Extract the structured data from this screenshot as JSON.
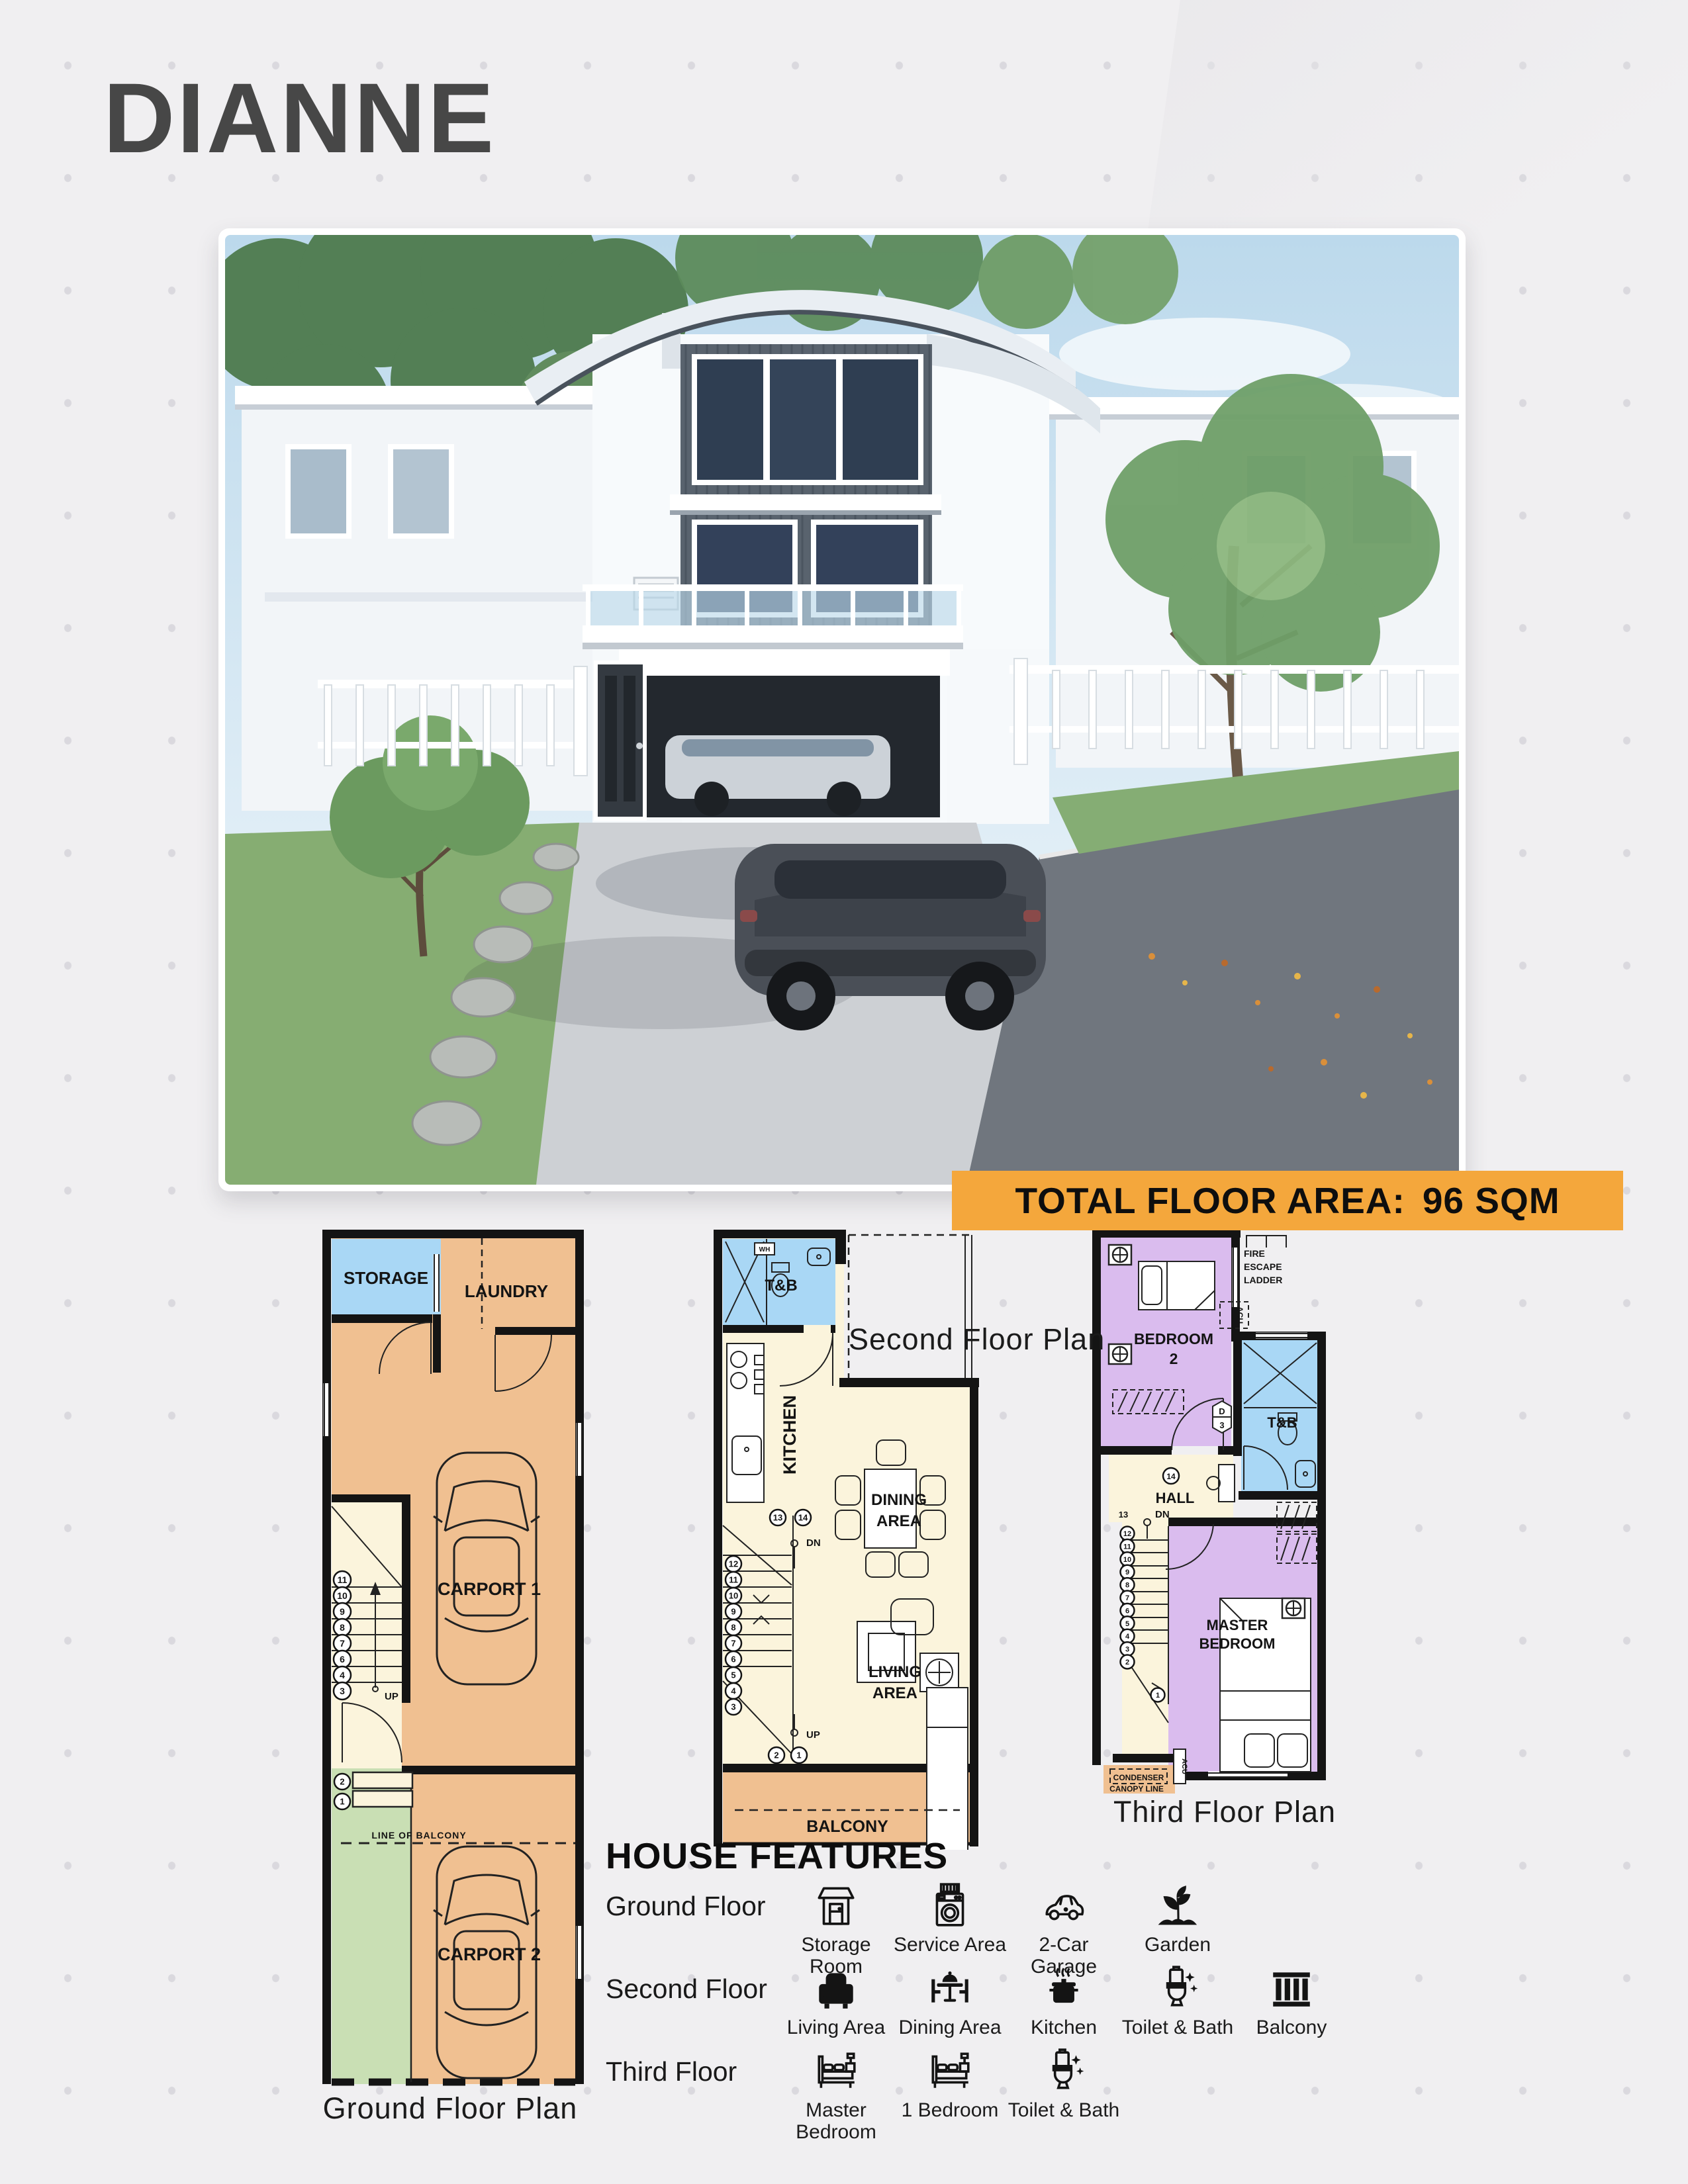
{
  "page": {
    "title": "DIANNE"
  },
  "banner": {
    "label": "TOTAL FLOOR AREA:",
    "value": "96 SQM",
    "bg": "#F4A73C"
  },
  "colors": {
    "background": "#F0EFF1",
    "accent_orange": "#F4A73C",
    "wall": "#141414",
    "room_tan": "#F0C091",
    "room_blue": "#A9D7F5",
    "room_cream": "#FBF4DC",
    "room_purple": "#DABCEE",
    "room_green": "#C9DFB4",
    "title_gray": "#474747"
  },
  "plans": {
    "ground": {
      "caption": "Ground Floor Plan",
      "labels": {
        "storage": "STORAGE",
        "laundry": "LAUNDRY",
        "carport1": "CARPORT 1",
        "carport2": "CARPORT 2",
        "line_of_balcony": "LINE OF BALCONY",
        "up": "UP"
      },
      "stairs": {
        "main": [
          "11",
          "10",
          "9",
          "8",
          "7",
          "6",
          "4",
          "3"
        ],
        "landing": [
          "2",
          "1"
        ]
      }
    },
    "second": {
      "caption": "Second Floor Plan",
      "labels": {
        "tb": "T&B",
        "wh": "WH",
        "kitchen": "KITCHEN",
        "dining1": "DINING",
        "dining2": "AREA",
        "living1": "LIVING",
        "living2": "AREA",
        "balcony": "BALCONY",
        "dn": "DN",
        "up": "UP"
      },
      "stairs": {
        "top": [
          "13",
          "14"
        ],
        "main": [
          "12",
          "11",
          "10",
          "9",
          "8",
          "7",
          "6",
          "5",
          "4",
          "3"
        ],
        "bottom": [
          "2",
          "1"
        ]
      }
    },
    "third": {
      "caption": "Third Floor Plan",
      "labels": {
        "bedroom2a": "BEDROOM",
        "bedroom2b": "2",
        "fire1": "FIRE",
        "fire2": "ESCAPE",
        "fire3": "LADDER",
        "acu_side": "ACU",
        "acu_bottom": "ACU",
        "tb": "T&B",
        "hall": "HALL",
        "dn": "DN",
        "step13": "13",
        "door_d": "D",
        "door_3": "3",
        "landing14": "14",
        "master1": "MASTER",
        "master2": "BEDROOM",
        "condenser": "CONDENSER",
        "canopy": "CANOPY LINE"
      },
      "stairs": {
        "main": [
          "12",
          "11",
          "10",
          "9",
          "8",
          "7",
          "6",
          "5",
          "4",
          "3",
          "2"
        ],
        "bottom": [
          "1"
        ]
      }
    }
  },
  "features": {
    "heading": "HOUSE FEATURES",
    "rows": [
      {
        "floor": "Ground Floor",
        "items": [
          {
            "icon": "storage-room-icon",
            "label": "Storage Room"
          },
          {
            "icon": "service-area-icon",
            "label": "Service Area"
          },
          {
            "icon": "car-garage-icon",
            "label": "2-Car Garage"
          },
          {
            "icon": "garden-icon",
            "label": "Garden"
          }
        ]
      },
      {
        "floor": "Second Floor",
        "items": [
          {
            "icon": "living-area-icon",
            "label": "Living Area"
          },
          {
            "icon": "dining-area-icon",
            "label": "Dining Area"
          },
          {
            "icon": "kitchen-icon",
            "label": "Kitchen"
          },
          {
            "icon": "toilet-bath-icon",
            "label": "Toilet & Bath"
          },
          {
            "icon": "balcony-icon",
            "label": "Balcony"
          }
        ]
      },
      {
        "floor": "Third Floor",
        "items": [
          {
            "icon": "master-bedroom-icon",
            "label": "Master Bedroom"
          },
          {
            "icon": "bedroom-icon",
            "label": "1 Bedroom"
          },
          {
            "icon": "toilet-bath-icon",
            "label": "Toilet & Bath"
          }
        ]
      }
    ]
  }
}
